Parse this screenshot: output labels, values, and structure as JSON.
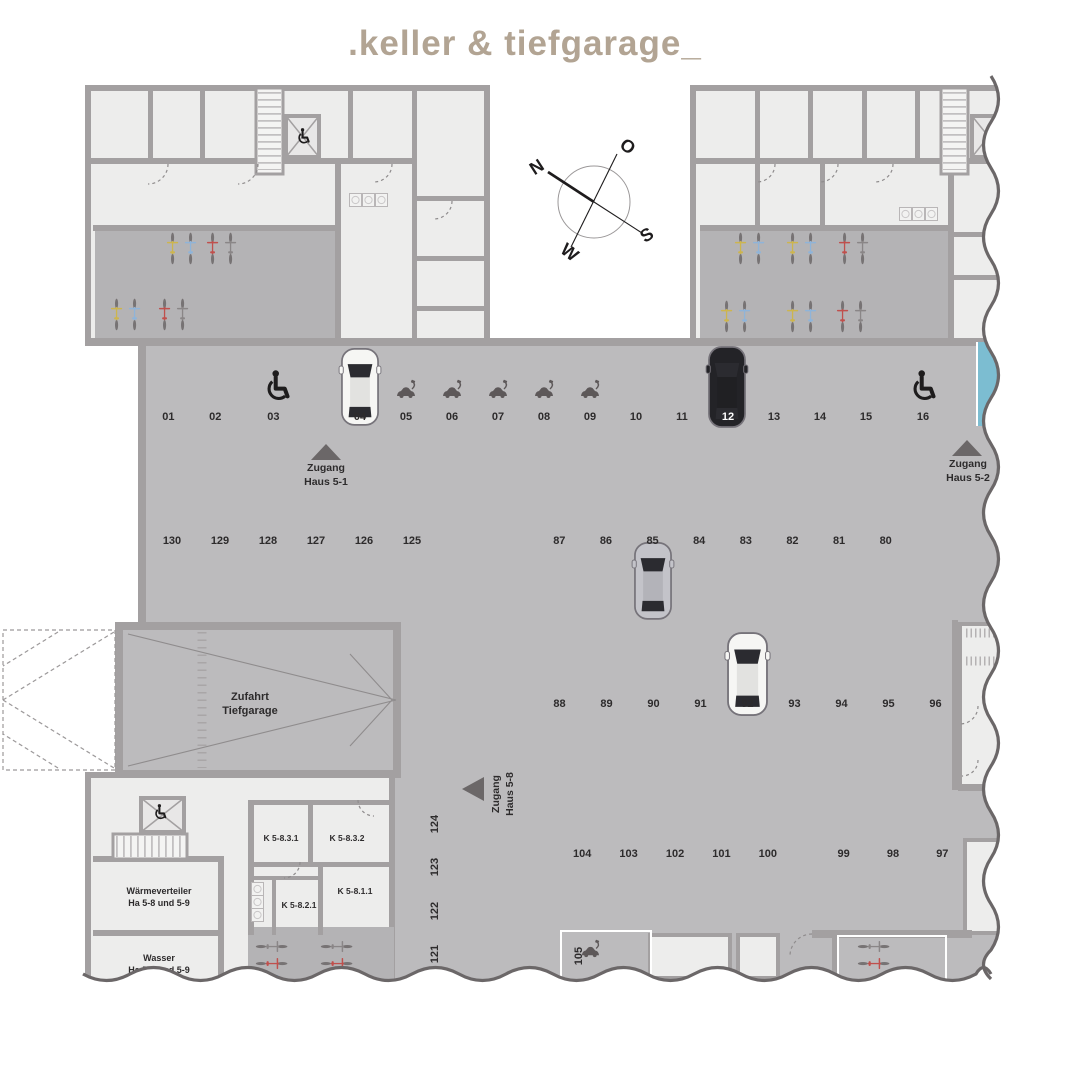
{
  "title": ".keller & tiefgarage_",
  "compass": {
    "north": "N",
    "east": "O",
    "south": "S",
    "west": "W"
  },
  "entrances": {
    "haus_5_1": {
      "line1": "Zugang",
      "line2": "Haus 5-1"
    },
    "haus_5_2": {
      "line1": "Zugang",
      "line2": "Haus 5-2"
    },
    "haus_5_8": {
      "line1": "Zugang",
      "line2": "Haus 5-8"
    }
  },
  "ramp": {
    "line1": "Zufahrt",
    "line2": "Tiefgarage"
  },
  "rooms": {
    "waermeverteiler": {
      "line1": "Wärmeverteiler",
      "line2": "Ha 5-8 und 5-9"
    },
    "wasser": {
      "line1": "Wasser",
      "line2": "Ha 5-8 und 5-9"
    },
    "k_5_8_3_1": "K 5-8.3.1",
    "k_5_8_3_2": "K 5-8.3.2",
    "k_5_8_1_1": "K 5-8.1.1",
    "k_5_8_2_1": "K 5-8.2.1"
  },
  "parking": {
    "row_top_left": [
      "01",
      "02",
      "03"
    ],
    "row_top_right": [
      "04",
      "05",
      "06",
      "07",
      "08",
      "09",
      "10",
      "11",
      "12",
      "13",
      "14",
      "15",
      "16"
    ],
    "row_mid_left": [
      "130",
      "129",
      "128",
      "127",
      "126",
      "125"
    ],
    "row_80s": [
      "87",
      "86",
      "85",
      "84",
      "83",
      "82",
      "81",
      "80"
    ],
    "row_90s": [
      "88",
      "89",
      "90",
      "91",
      "92",
      "93",
      "94",
      "95",
      "96"
    ],
    "row_100s": [
      "104",
      "103",
      "102",
      "101",
      "100"
    ],
    "row_97s": [
      "99",
      "98",
      "97"
    ],
    "col_left": [
      "124",
      "123",
      "122",
      "121"
    ],
    "spot_105": "105"
  },
  "features": {
    "wheelchair_spots": [
      "03",
      "16"
    ],
    "ev_charging_spots": [
      "05",
      "06",
      "07",
      "08",
      "09",
      "105"
    ],
    "parked_cars": [
      {
        "spot": "04",
        "color": "white"
      },
      {
        "spot": "12",
        "color": "black"
      },
      {
        "spot": "85",
        "color": "silver"
      },
      {
        "spot": "92",
        "color": "white"
      }
    ],
    "highlighted_spot_count": 3
  },
  "colors": {
    "title": "#b2a493",
    "highlight": "#7cbdd1",
    "floor": "#bcbbbd",
    "wall": "#a3a0a1"
  }
}
